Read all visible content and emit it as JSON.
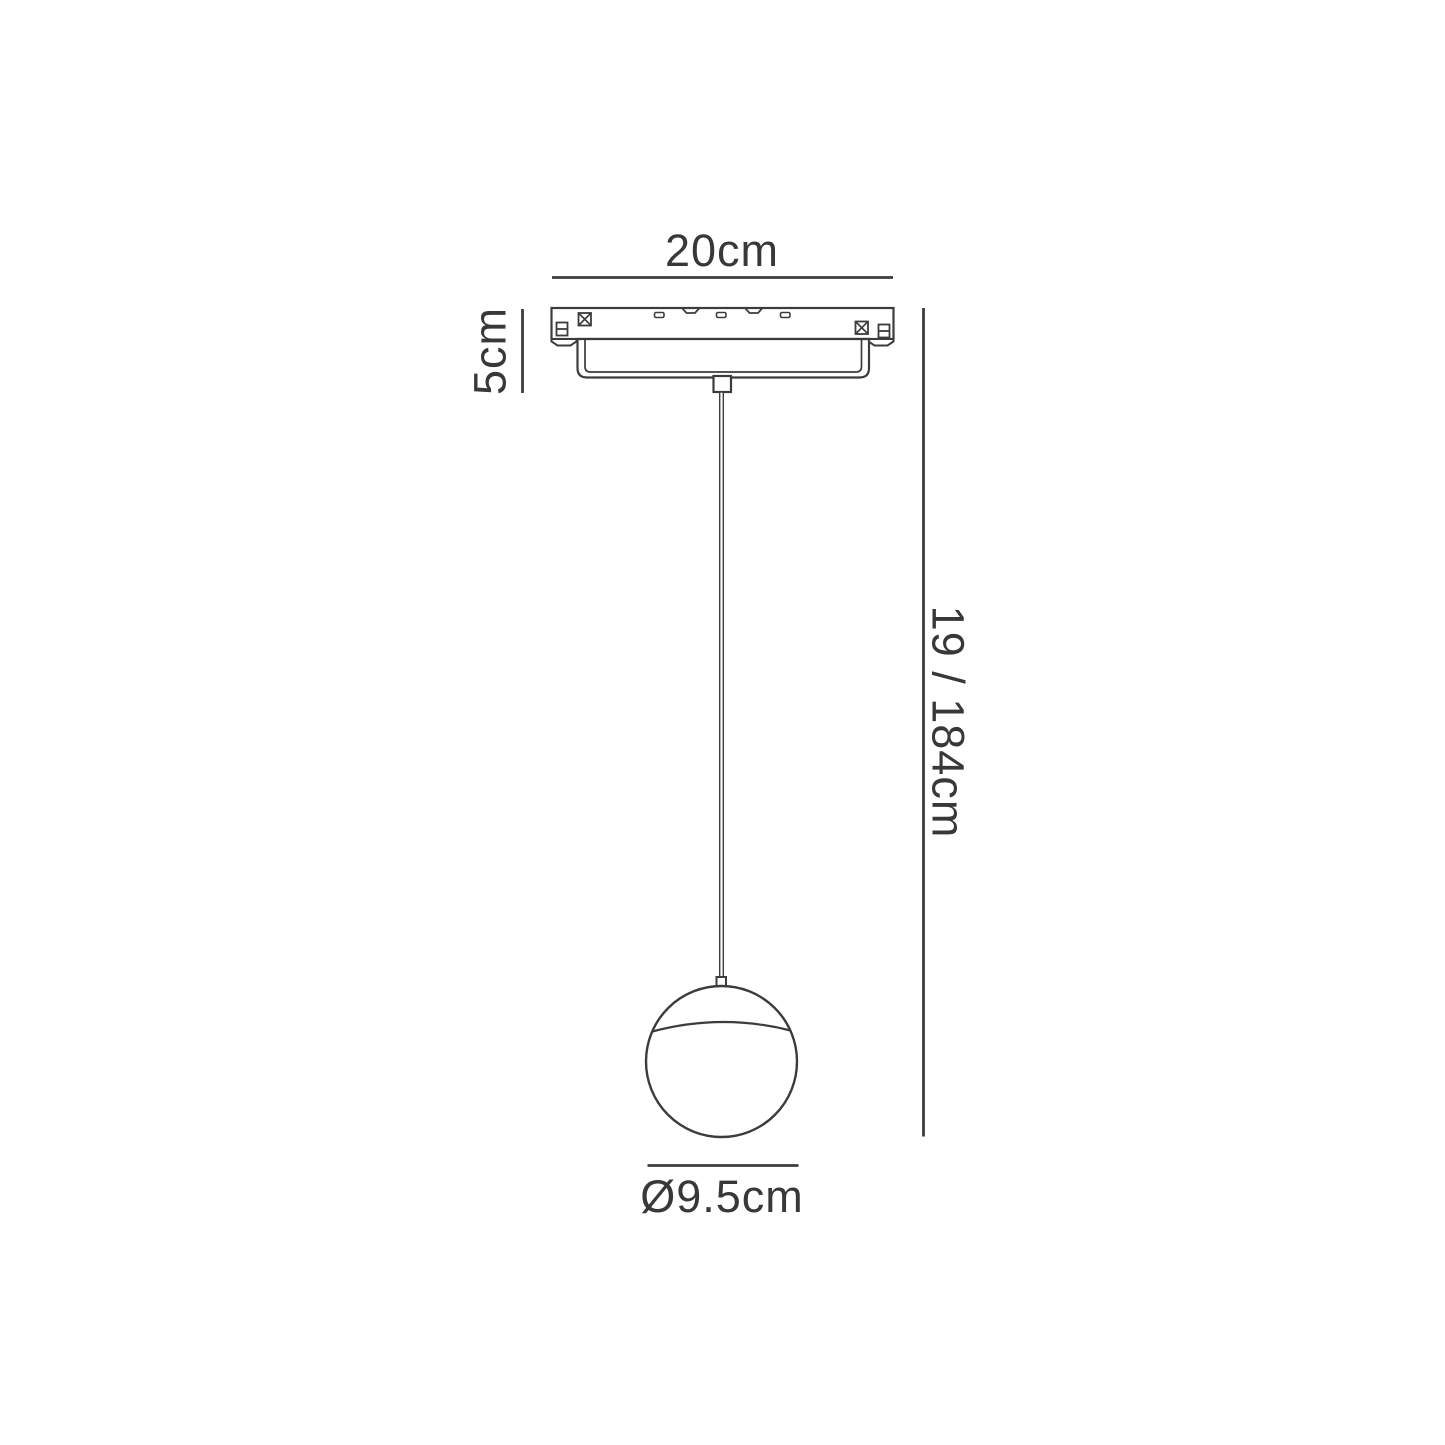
{
  "drawing": {
    "background_color": "#FFFFFF",
    "line_color": "#3C3C3C",
    "text_color": "#383838",
    "labels": {
      "track_width": "20cm",
      "fixture_height": "5cm",
      "drop_length": "19 / 184cm",
      "shade_diameter": "Ø9.5cm"
    }
  }
}
